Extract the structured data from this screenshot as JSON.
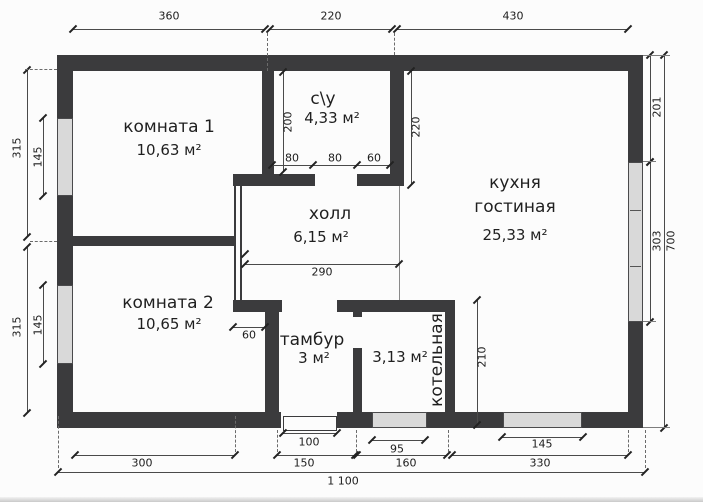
{
  "plan_title": "floor-plan",
  "rooms": [
    {
      "name": "комната 1",
      "area": "10,63 м²"
    },
    {
      "name": "с\\у",
      "area": "4,33 м²"
    },
    {
      "name": "холл",
      "area": "6,15 м²"
    },
    {
      "name": "кухня",
      "name2": "гостиная",
      "area": "25,33 м²"
    },
    {
      "name": "комната 2",
      "area": "10,65 м²"
    },
    {
      "name": "тамбур",
      "area": "3 м²"
    },
    {
      "name": "котельная",
      "area": "3,13 м²"
    }
  ],
  "dims": {
    "top": [
      "360",
      "220",
      "430"
    ],
    "left": [
      "315",
      "145",
      "315",
      "145"
    ],
    "right": [
      "201",
      "303",
      "700"
    ],
    "bottom_openings": [
      "100",
      "95",
      "145"
    ],
    "bottom_segments": [
      "300",
      "150",
      "160",
      "330"
    ],
    "total_width": "1 100",
    "inner": {
      "su_height": "200",
      "su_a": "80",
      "su_b": "80",
      "su_c": "60",
      "kitchen_wall": "220",
      "hall_width": "290",
      "tambour_stub": "60",
      "boiler_height": "210"
    }
  },
  "colors": {
    "wall": "#3b3b3d",
    "window_fill": "#d9d9d9",
    "background": "#fcfcfc",
    "line": "#4a4a4a"
  }
}
